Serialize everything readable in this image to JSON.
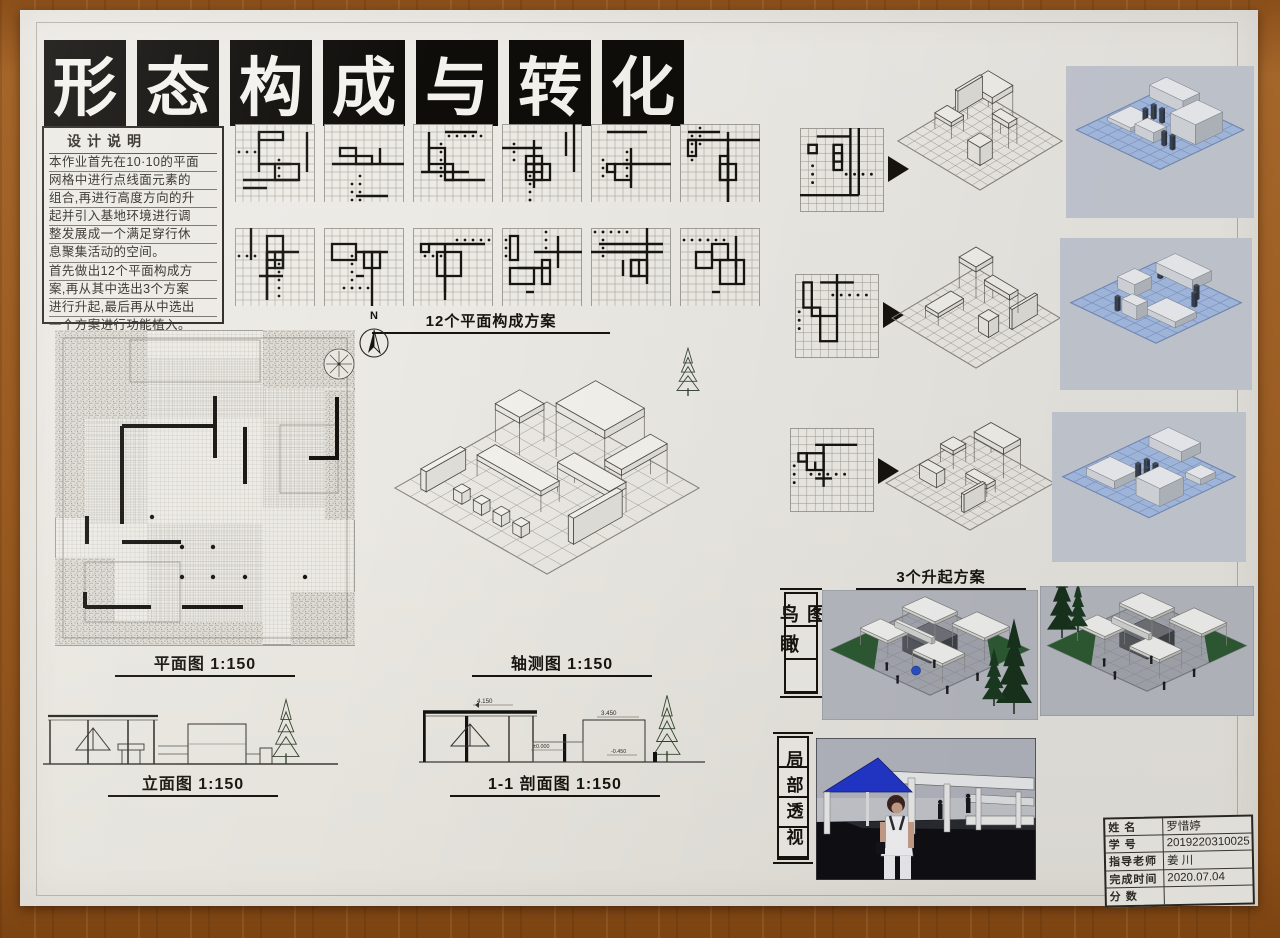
{
  "poster": {
    "title": "形态构成与转化",
    "title_chars": [
      "形",
      "态",
      "构",
      "成",
      "与",
      "转",
      "化"
    ],
    "design_notes": {
      "heading": "设计说明",
      "lines": [
        "本作业首先在10·10的平面",
        "网格中进行点线面元素的",
        "组合,再进行高度方向的升",
        "起并引入基地环境进行调",
        "整发展成一个满足穿行休",
        "息聚集活动的空间。",
        "首先做出12个平面构成方",
        "案,再从其中选出3个方案",
        "进行升起,最后再从中选出",
        "一个方案进行功能植入。"
      ]
    },
    "labels": {
      "plans12": "12个平面构成方案",
      "plan": "平面图 1:150",
      "axon": "轴测图 1:150",
      "elevation": "立面图 1:150",
      "section": "1-1 剖面图 1:150",
      "lift3": "3个升起方案",
      "birdseye": "鸟瞰图",
      "perspective": "局部透视",
      "north": "N"
    },
    "section_dims": {
      "roof": "4.150",
      "box": "3.450",
      "ground": "±0.000",
      "sunken": "-0.450"
    },
    "title_block": {
      "rows": [
        {
          "label": "姓 名",
          "value": "罗惜婷"
        },
        {
          "label": "学 号",
          "value": "2019220310025"
        },
        {
          "label": "指导老师",
          "value": "姜 川"
        },
        {
          "label": "完成时间",
          "value": "2020.07.04"
        },
        {
          "label": "分 数",
          "value": ""
        }
      ]
    },
    "colors": {
      "canopy_blue": "#2236c9",
      "model_blue": "#a6bde4",
      "lawn_green": "#2d5a33",
      "tree_green": "#17331d",
      "paper": "#eae8e2",
      "wood": "#9a5c22"
    }
  }
}
